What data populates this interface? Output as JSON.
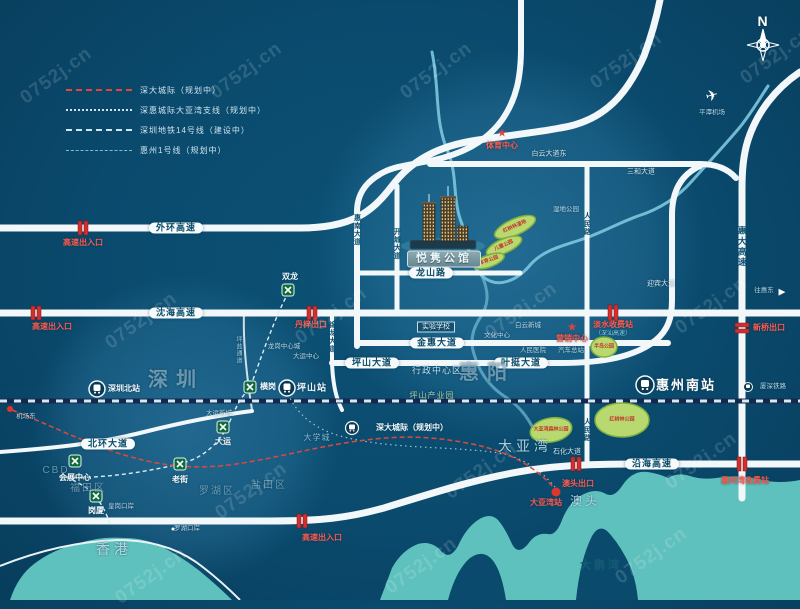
{
  "watermark": {
    "text": "0752j.cn",
    "positions": [
      [
        55,
        65
      ],
      [
        245,
        60
      ],
      [
        435,
        60
      ],
      [
        625,
        50
      ],
      [
        775,
        45
      ],
      [
        140,
        310
      ],
      [
        330,
        305
      ],
      [
        520,
        300
      ],
      [
        710,
        295
      ],
      [
        250,
        480
      ],
      [
        480,
        460
      ],
      [
        700,
        450
      ],
      [
        150,
        565
      ],
      [
        420,
        555
      ],
      [
        650,
        545
      ]
    ]
  },
  "legend": {
    "items": [
      {
        "label": "深大城际（规划中）",
        "line": "red-dashed"
      },
      {
        "label": "深惠城际大亚湾支线（规划中）",
        "line": "dotted"
      },
      {
        "label": "深圳地铁14号线（建设中）",
        "line": "dashed"
      },
      {
        "label": "惠州1号线（规划中）",
        "line": "fine-dashed"
      }
    ]
  },
  "colors": {
    "background": "#0a4a6d",
    "road": "#f2f7f9",
    "water": "#5fc1bd",
    "park": "#b8d96f",
    "alert_red": "#e0483e",
    "metro_green": "#0e6b40",
    "river": "#7cc6de",
    "railway": "#13294e"
  },
  "project": {
    "name": "悦隽公馆"
  },
  "labels": [
    {
      "name": "outer-ring-expwy-label",
      "text": "外环高速",
      "x": 176,
      "y": 228,
      "cls": "pill"
    },
    {
      "name": "shenhai-expwy-label",
      "text": "沈海高速",
      "x": 176,
      "y": 313,
      "cls": "pill"
    },
    {
      "name": "yanhai-expwy-label",
      "text": "沿海高速",
      "x": 652,
      "y": 464,
      "cls": "pill"
    },
    {
      "name": "jinhui-ave-label",
      "text": "金惠大道",
      "x": 437,
      "y": 343,
      "cls": "pill"
    },
    {
      "name": "pingshan-ave-label",
      "text": "坪山大道",
      "x": 372,
      "y": 363,
      "cls": "pill"
    },
    {
      "name": "yeting-ave-label",
      "text": "叶挺大道",
      "x": 521,
      "y": 363,
      "cls": "pill"
    },
    {
      "name": "longshan-rd-label",
      "text": "龙山路",
      "x": 431,
      "y": 273,
      "cls": "pill"
    },
    {
      "name": "beihuan-ave-label",
      "text": "北环大道",
      "x": 108,
      "y": 444,
      "cls": "pill"
    },
    {
      "name": "huinan-ave-label",
      "text": "惠南大道",
      "x": 357,
      "y": 230,
      "cls": "vroad"
    },
    {
      "name": "kaicheng-ave-label",
      "text": "开城大道",
      "x": 397,
      "y": 244,
      "cls": "vroad"
    },
    {
      "name": "renmin-rd-label-north",
      "text": "人民路",
      "x": 587,
      "y": 224,
      "cls": "vroad"
    },
    {
      "name": "renmin-rd-label-south",
      "text": "人民路",
      "x": 587,
      "y": 430,
      "cls": "vroad"
    },
    {
      "name": "huida-expwy-label",
      "text": "惠大高速",
      "x": 742,
      "y": 247,
      "cls": "vroad-lg"
    },
    {
      "name": "jinlong-ave-label",
      "text": "锦龙大道",
      "x": 332,
      "y": 337,
      "cls": "vroad"
    },
    {
      "name": "pingyan-rd-label",
      "text": "坪盐通道",
      "x": 238,
      "y": 350,
      "cls": "vlight"
    },
    {
      "name": "baiyun-ave-east-label",
      "text": "白云大道东",
      "x": 549,
      "y": 154,
      "cls": "rdsm"
    },
    {
      "name": "sanhe-ave-label",
      "text": "三和大道",
      "x": 641,
      "y": 172,
      "cls": "rdsm"
    },
    {
      "name": "shihua-ave-label",
      "text": "石化大道",
      "x": 567,
      "y": 452,
      "cls": "rdsm"
    },
    {
      "name": "yingbin-ave-label",
      "text": "迎宾大道",
      "x": 661,
      "y": 284,
      "cls": "rdsm"
    },
    {
      "name": "exit-outer-ring-label",
      "text": "高速出入口",
      "x": 83,
      "y": 243,
      "cls": "red"
    },
    {
      "name": "exit-shenhai-west-label",
      "text": "高速出入口",
      "x": 52,
      "y": 327,
      "cls": "red"
    },
    {
      "name": "exit-yanhai-west-label",
      "text": "高速出入口",
      "x": 322,
      "y": 538,
      "cls": "red"
    },
    {
      "name": "danzi-exit-label",
      "text": "丹梓出口",
      "x": 311,
      "y": 325,
      "cls": "red"
    },
    {
      "name": "danshui-toll-label",
      "text": "淡水收费站",
      "x": 613,
      "y": 325,
      "cls": "red"
    },
    {
      "name": "xinqiao-exit-label",
      "text": "新桥出口",
      "x": 769,
      "y": 328,
      "cls": "red"
    },
    {
      "name": "aotou-exit-label",
      "text": "澳头出口",
      "x": 578,
      "y": 484,
      "cls": "red"
    },
    {
      "name": "huizhouwan-toll-label",
      "text": "惠州湾收费站",
      "x": 745,
      "y": 481,
      "cls": "red"
    },
    {
      "name": "dayawan-station-label",
      "text": "大亚湾站",
      "x": 546,
      "y": 503,
      "cls": "red"
    },
    {
      "name": "sports-center-label",
      "text": "体育中心",
      "x": 502,
      "y": 146,
      "cls": "red"
    },
    {
      "name": "marketing-center-label",
      "text": "营销中心",
      "x": 572,
      "y": 339,
      "cls": "red"
    },
    {
      "name": "shenshan-expwy-note",
      "text": "（深汕高速）",
      "x": 613,
      "y": 334,
      "cls": "cyan"
    },
    {
      "name": "baiyun-newtown-label",
      "text": "白云新城",
      "x": 528,
      "y": 326,
      "cls": "tiny"
    },
    {
      "name": "culture-center-label",
      "text": "文化中心",
      "x": 497,
      "y": 336,
      "cls": "tiny"
    },
    {
      "name": "peoples-hospital-label",
      "text": "人民医院",
      "x": 533,
      "y": 351,
      "cls": "tiny"
    },
    {
      "name": "bus-terminal-label",
      "text": "汽车总站",
      "x": 571,
      "y": 351,
      "cls": "tiny"
    },
    {
      "name": "wetland-park-label",
      "text": "湿地公园",
      "x": 566,
      "y": 210,
      "cls": "tiny"
    },
    {
      "name": "longgang-center-label",
      "text": "龙岗中心城",
      "x": 284,
      "y": 347,
      "cls": "tiny"
    },
    {
      "name": "dayun-center-label",
      "text": "大运中心",
      "x": 306,
      "y": 357,
      "cls": "tiny"
    },
    {
      "name": "dayun-newtown-label",
      "text": "大运新城",
      "x": 219,
      "y": 414,
      "cls": "tiny"
    },
    {
      "name": "huanggang-port-label",
      "text": "皇岗口岸",
      "x": 121,
      "y": 507,
      "cls": "tiny"
    },
    {
      "name": "luohu-port-label",
      "text": "罗湖口岸",
      "x": 187,
      "y": 529,
      "cls": "tiny"
    },
    {
      "name": "airport-east-label",
      "text": "机场东",
      "x": 26,
      "y": 417,
      "cls": "tiny"
    },
    {
      "name": "experimental-school-label",
      "text": "实验学校",
      "x": 436,
      "y": 327,
      "cls": "boxlbl"
    },
    {
      "name": "shenzhen-label",
      "text": "深圳",
      "x": 176,
      "y": 380,
      "cls": "area-lg"
    },
    {
      "name": "huiyang-label",
      "text": "惠阳",
      "x": 487,
      "y": 373,
      "cls": "area-lg"
    },
    {
      "name": "hongkong-label",
      "text": "香港",
      "x": 114,
      "y": 549,
      "cls": "area-md"
    },
    {
      "name": "dayawan-label",
      "text": "大亚湾",
      "x": 525,
      "y": 446,
      "cls": "area-md"
    },
    {
      "name": "aotou-label",
      "text": "澳头",
      "x": 585,
      "y": 501,
      "cls": "area-sm2"
    },
    {
      "name": "dapengwan-label",
      "text": "大鹏湾",
      "x": 601,
      "y": 566,
      "cls": "area-dark"
    },
    {
      "name": "luohu-district-label",
      "text": "罗湖区",
      "x": 217,
      "y": 492,
      "cls": "area-sm"
    },
    {
      "name": "futian-district-label",
      "text": "福田区",
      "x": 88,
      "y": 489,
      "cls": "area-sm"
    },
    {
      "name": "yantian-district-label",
      "text": "盐田区",
      "x": 269,
      "y": 486,
      "cls": "area-sm"
    },
    {
      "name": "cbd-label",
      "text": "CBD",
      "x": 56,
      "y": 471,
      "cls": "area-sm"
    },
    {
      "name": "admin-center-label",
      "text": "行政中心区",
      "x": 437,
      "y": 371,
      "cls": "area-xs"
    },
    {
      "name": "pingshan-industrial-label",
      "text": "坪山产业园",
      "x": 432,
      "y": 396,
      "cls": "green-tiny"
    },
    {
      "name": "university-town-label",
      "text": "大学城",
      "x": 317,
      "y": 438,
      "cls": "blue-tiny"
    },
    {
      "name": "shuanglong-label",
      "text": "双龙",
      "x": 290,
      "y": 277,
      "cls": "stn"
    },
    {
      "name": "henggang-label",
      "text": "横岗",
      "x": 268,
      "y": 387,
      "cls": "stn"
    },
    {
      "name": "dayun-label",
      "text": "大运",
      "x": 223,
      "y": 442,
      "cls": "stn"
    },
    {
      "name": "laojie-label",
      "text": "老街",
      "x": 180,
      "y": 480,
      "cls": "stn"
    },
    {
      "name": "convention-center-label",
      "text": "会展中心",
      "x": 75,
      "y": 478,
      "cls": "stn"
    },
    {
      "name": "gangxia-label",
      "text": "岗厦",
      "x": 96,
      "y": 511,
      "cls": "stn"
    },
    {
      "name": "shenzhen-north-station-label",
      "text": "深圳北站",
      "x": 124,
      "y": 389,
      "cls": "stn"
    },
    {
      "name": "pingshan-station-label",
      "text": "坪山站",
      "x": 312,
      "y": 388,
      "cls": "stn-b"
    },
    {
      "name": "huizhou-south-station-label",
      "text": "惠州南站",
      "x": 686,
      "y": 385,
      "cls": "stn-xl"
    },
    {
      "name": "xiashen-railway-label",
      "text": "厦深铁路",
      "x": 773,
      "y": 387,
      "cls": "tiny"
    },
    {
      "name": "shenda-intercity-label",
      "text": "深大城际（规划中）",
      "x": 412,
      "y": 428,
      "cls": "stn"
    },
    {
      "name": "pingtan-airport-label",
      "text": "平潭机场",
      "x": 712,
      "y": 113,
      "cls": "tiny"
    },
    {
      "name": "to-huidong-label",
      "text": "往惠东",
      "x": 764,
      "y": 291,
      "cls": "tiny"
    },
    {
      "name": "north-label",
      "text": "N",
      "x": 763,
      "y": 21,
      "cls": "north"
    },
    {
      "name": "park-label-mangrove-wetland",
      "text": "红树林湿地",
      "x": 515,
      "y": 227,
      "cls": "park",
      "r": -24
    },
    {
      "name": "park-label-children",
      "text": "儿童公园",
      "x": 504,
      "y": 246,
      "cls": "park",
      "r": -24
    },
    {
      "name": "park-label-sports",
      "text": "体育公园",
      "x": 489,
      "y": 261,
      "cls": "park",
      "r": -20
    },
    {
      "name": "park-label-peninsula",
      "text": "半岛公园",
      "x": 604,
      "y": 347,
      "cls": "park"
    },
    {
      "name": "park-label-dayawan-forest",
      "text": "大亚湾森林公园",
      "x": 551,
      "y": 430,
      "cls": "park"
    },
    {
      "name": "park-label-mangrove",
      "text": "红树林公园",
      "x": 622,
      "y": 420,
      "cls": "park"
    },
    {
      "name": "project-name-label",
      "text": "悦隽公馆",
      "x": 444,
      "y": 259,
      "cls": "projlbl"
    },
    {
      "name": "plane-icon",
      "text": "✈",
      "x": 712,
      "y": 96,
      "cls": "plane",
      "r": -15
    },
    {
      "name": "arrow-up-icon",
      "text": "▲",
      "x": 521,
      "y": 62,
      "cls": "arrowup"
    },
    {
      "name": "arrow-right-icon",
      "text": "▶",
      "x": 782,
      "y": 292,
      "cls": "arrowright"
    },
    {
      "name": "star-icon-sports-center",
      "text": "★",
      "x": 502,
      "y": 134,
      "cls": "star"
    },
    {
      "name": "star-icon-marketing-center",
      "text": "★",
      "x": 572,
      "y": 328,
      "cls": "star"
    }
  ]
}
